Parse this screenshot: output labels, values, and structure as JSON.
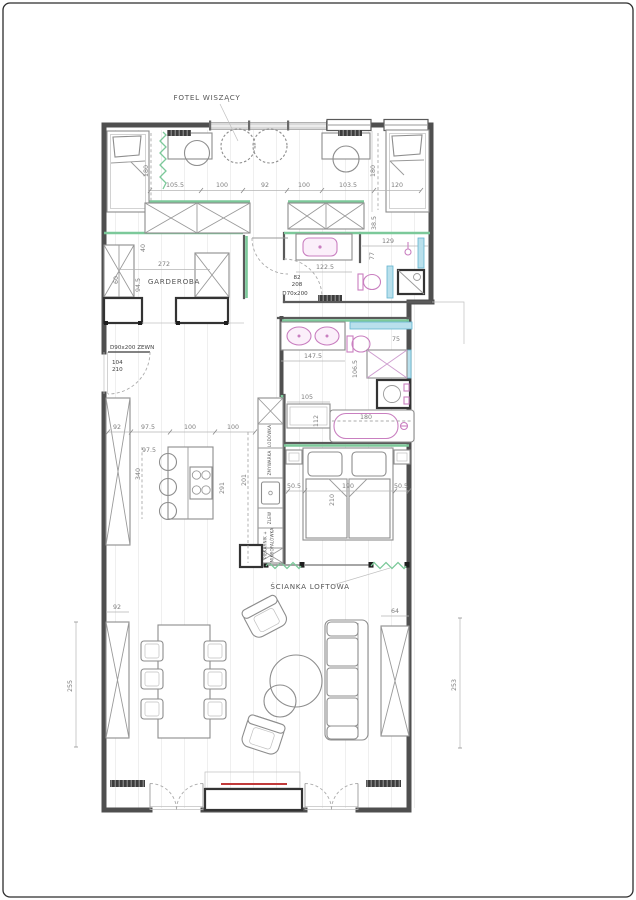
{
  "plan": {
    "labels": {
      "hanging_chair": "FOTEL WISZĄCY",
      "wardrobe_room": "GARDEROBA",
      "loft_wall": "ŚCIANKA LOFTOWA"
    },
    "doors": {
      "entry_spec": "D90x200 ZEWN",
      "entry_w": "104",
      "entry_h": "210",
      "bath_spec": "D70x200",
      "bath_w": "82",
      "bath_h": "208"
    },
    "kitchen": {
      "fridge": "LODÓWKA",
      "dishwasher": "ZMYWARKA",
      "sink": "ZLEW",
      "oven1": "PIEKARNIK +",
      "oven2": "MIKROFALÓWKA"
    },
    "dims": {
      "v105_5": "105.5",
      "v100": "100",
      "v92": "92",
      "v103_5": "103.5",
      "v120": "120",
      "v180": "180",
      "v60": "60",
      "v39_5": "39.5",
      "v38_5": "38.5",
      "v40": "40",
      "v272": "272",
      "v94_5": "94.5",
      "v122_5": "122.5",
      "v129": "129",
      "v77": "77",
      "v147_5": "147.5",
      "v75": "75",
      "v106_5": "106.5",
      "v105": "105",
      "v112": "112",
      "v97_5": "97.5",
      "v340": "340",
      "v291": "291",
      "v201": "201",
      "v50_5": "50.5",
      "v190": "190",
      "v210": "210",
      "v64": "64",
      "v255": "255",
      "v253": "253"
    },
    "colors": {
      "wall": "#4f4f4f",
      "new_wall_green": "#7cc99a",
      "tiles_cyan": "#a9d9e8",
      "fixture_magenta": "#c97fc0",
      "tv_red": "#c03a3a"
    }
  }
}
